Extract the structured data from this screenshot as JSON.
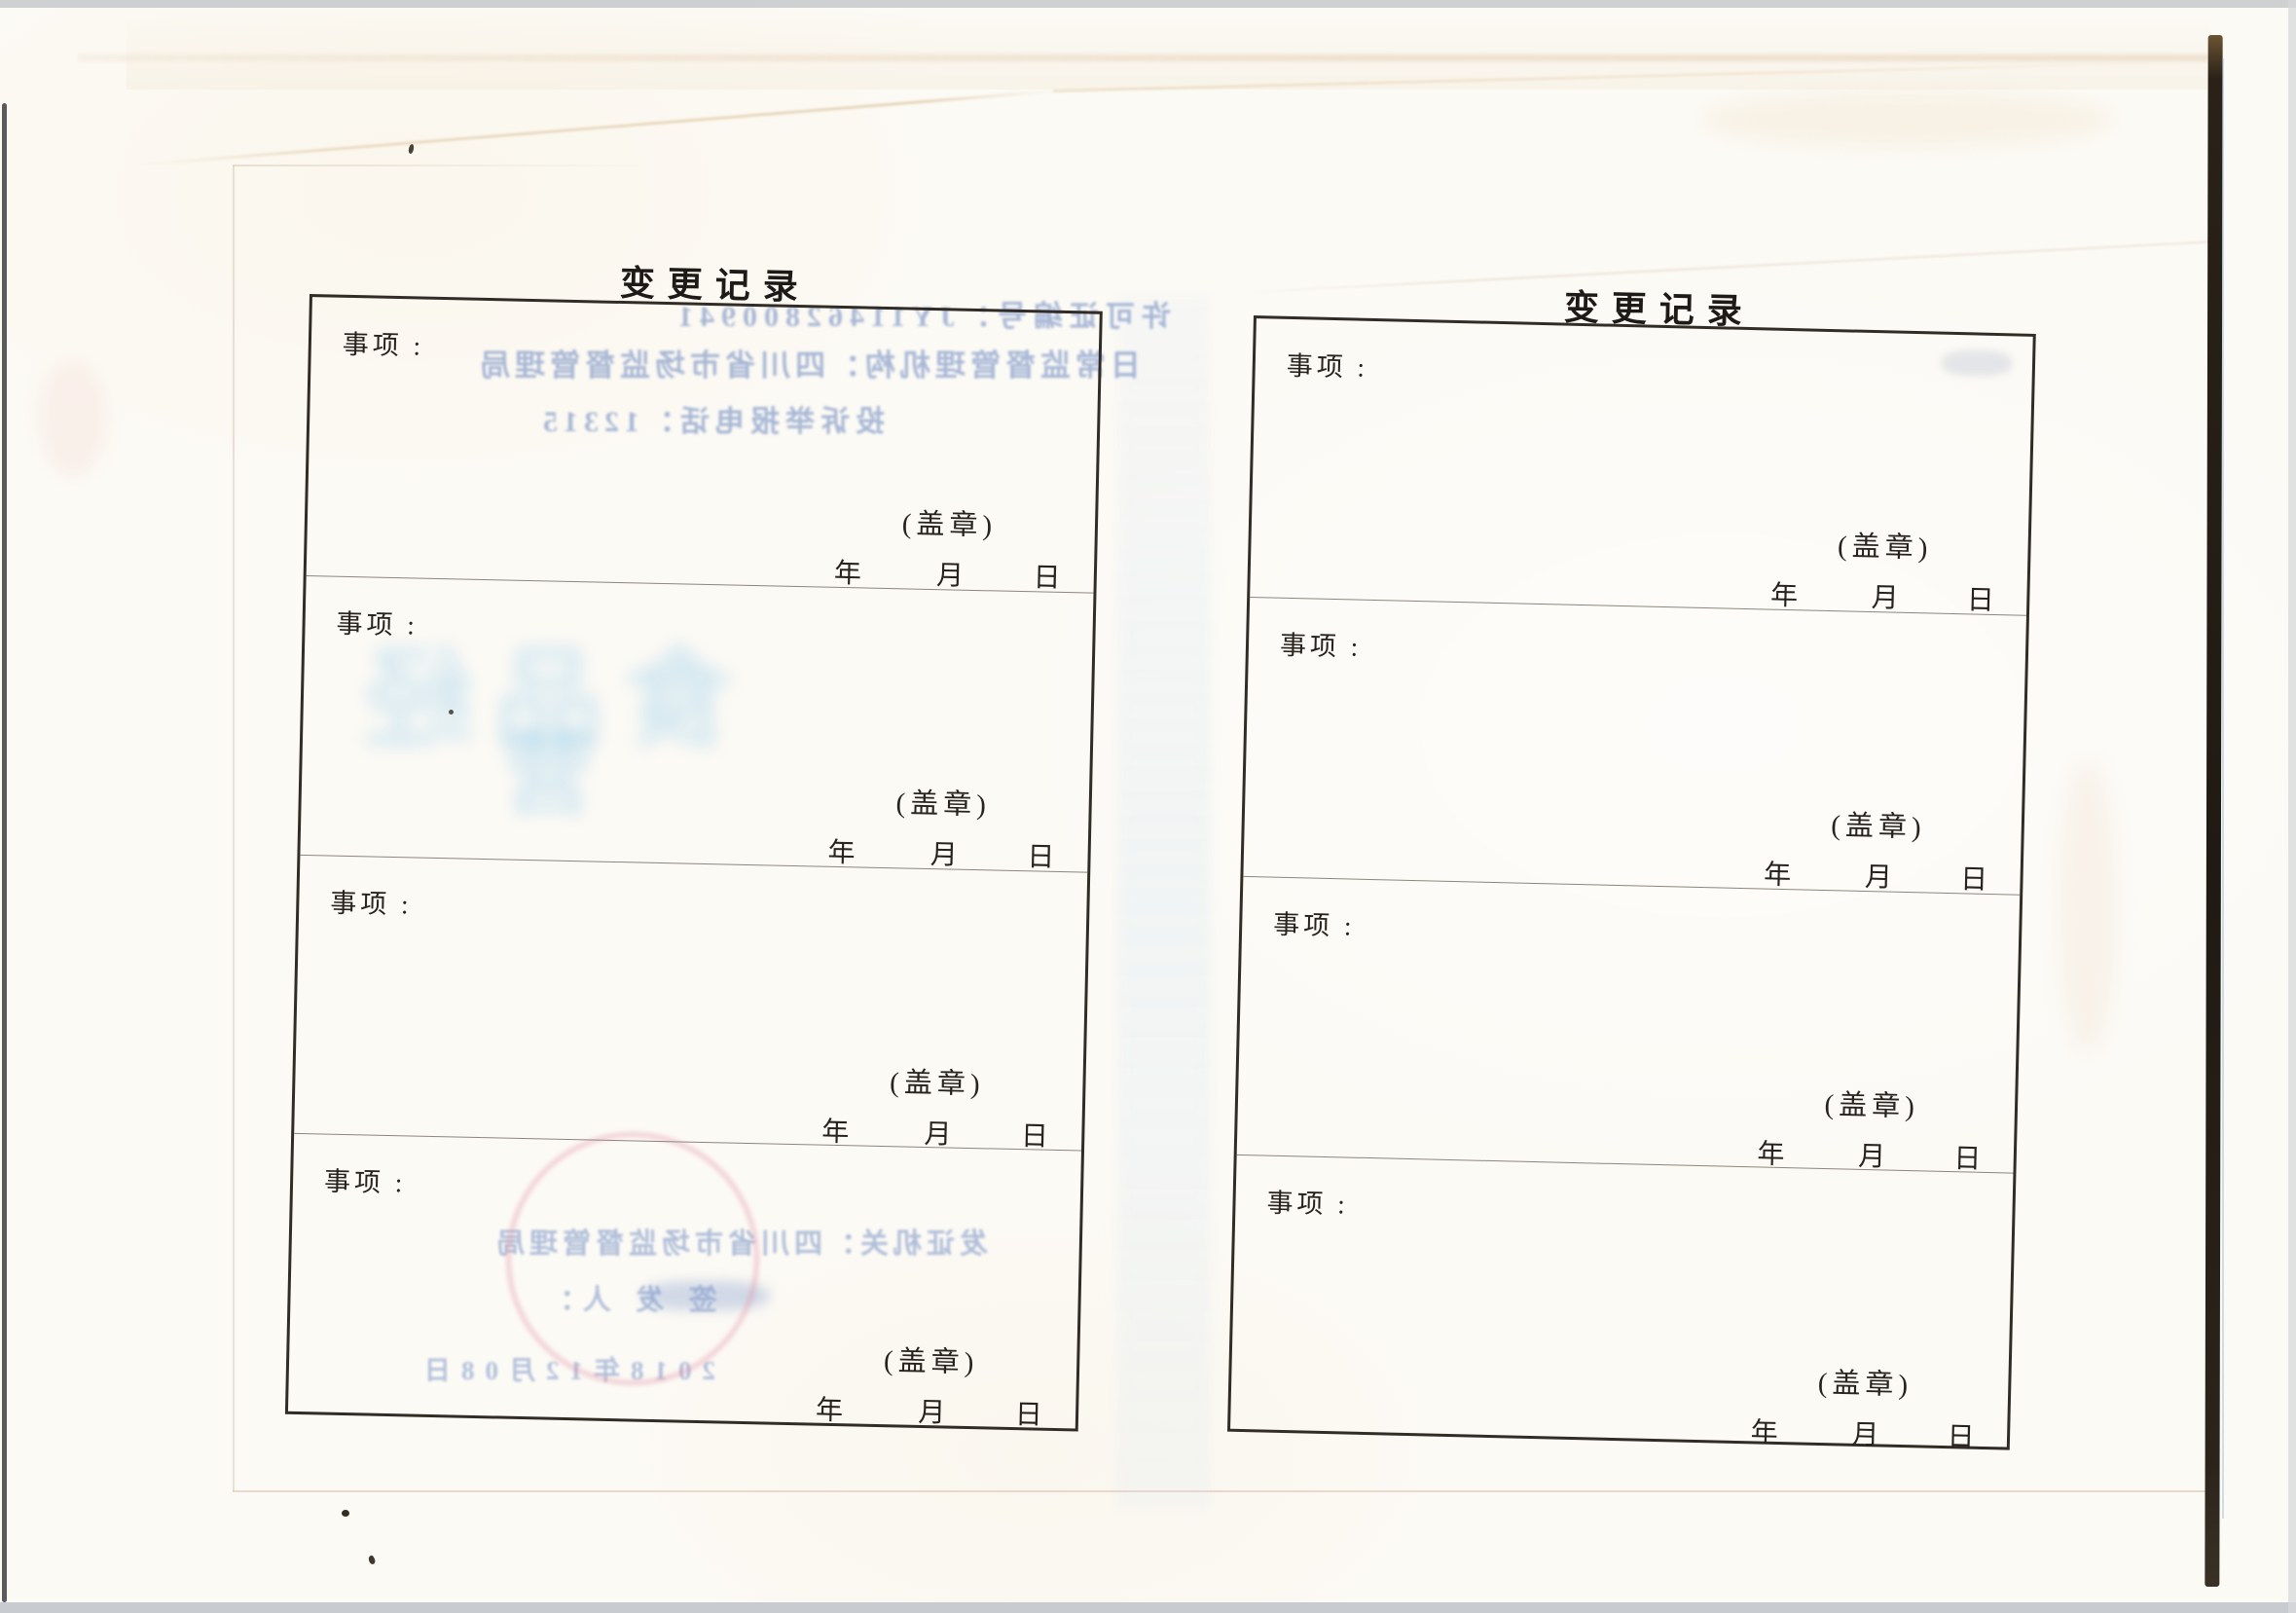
{
  "document": {
    "kind": "scanned booklet spread — change record form",
    "pages": [
      {
        "title": "变 更 记 录",
        "sections": [
          {
            "item_label": "事项 :",
            "seal_label": "(盖章)",
            "year_label": "年",
            "month_label": "月",
            "day_label": "日"
          },
          {
            "item_label": "事项 :",
            "seal_label": "(盖章)",
            "year_label": "年",
            "month_label": "月",
            "day_label": "日"
          },
          {
            "item_label": "事项 :",
            "seal_label": "(盖章)",
            "year_label": "年",
            "month_label": "月",
            "day_label": "日"
          },
          {
            "item_label": "事项 :",
            "seal_label": "(盖章)",
            "year_label": "年",
            "month_label": "月",
            "day_label": "日"
          }
        ],
        "bleed_through": {
          "note": "mirrored ink show-through from reverse side of the sheet",
          "permit_no_line": "许可证编号：JY11462800941",
          "supervision_line": "日常监督管理机构：四川省市场监督管理局",
          "hotline_line": "投诉举报电话：12315",
          "large_ghost_line1": "食品经",
          "large_ghost_line2": "营",
          "issuer_line": "发证机关：四川省市场监督管理局",
          "signer_line": "签 发 人：",
          "date_line": "2018年12月08日"
        }
      },
      {
        "title": "变 更 记 录",
        "sections": [
          {
            "item_label": "事项 :",
            "seal_label": "(盖章)",
            "year_label": "年",
            "month_label": "月",
            "day_label": "日"
          },
          {
            "item_label": "事项 :",
            "seal_label": "(盖章)",
            "year_label": "年",
            "month_label": "月",
            "day_label": "日"
          },
          {
            "item_label": "事项 :",
            "seal_label": "(盖章)",
            "year_label": "年",
            "month_label": "月",
            "day_label": "日"
          },
          {
            "item_label": "事项 :",
            "seal_label": "(盖章)",
            "year_label": "年",
            "month_label": "月",
            "day_label": "日"
          }
        ]
      }
    ],
    "colors": {
      "paper": "#fcfaf5",
      "ink": "#27221d",
      "box_border": "#322c26",
      "divider": "#8d867e",
      "bleed_blue": "#6282be",
      "ghost_cyan": "#96cdeb",
      "stamp_pink": "#e28ca2",
      "spine_black": "#201a14",
      "scanner_gray": "#c6c8cb"
    }
  }
}
